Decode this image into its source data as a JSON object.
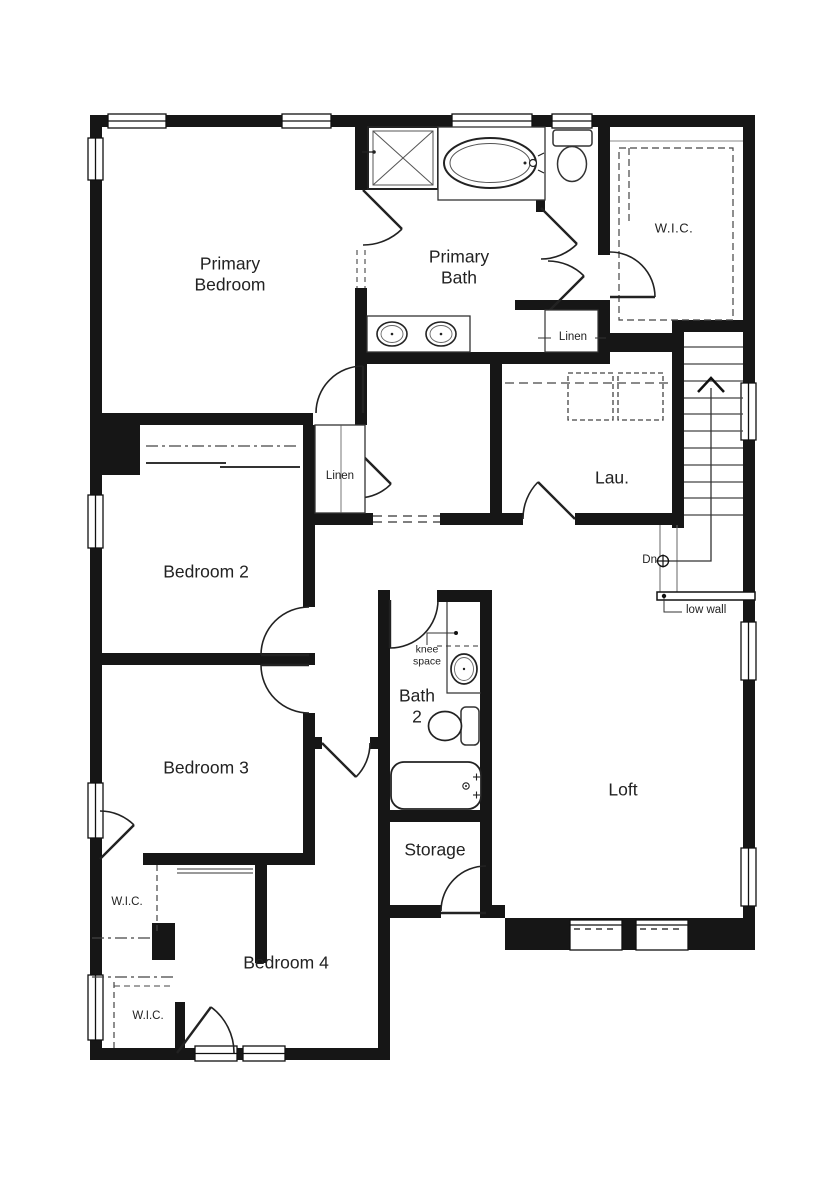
{
  "plan": {
    "rooms": {
      "primary_bedroom": {
        "line1": "Primary",
        "line2": "Bedroom"
      },
      "primary_bath": {
        "line1": "Primary",
        "line2": "Bath"
      },
      "wic_primary": {
        "label": "W.I.C."
      },
      "linen_bath": {
        "label": "Linen"
      },
      "linen_hall": {
        "label": "Linen"
      },
      "laundry": {
        "label": "Lau."
      },
      "bedroom_2": {
        "label": "Bedroom 2"
      },
      "bedroom_3": {
        "label": "Bedroom 3"
      },
      "bath_2": {
        "line1": "Bath",
        "line2": "2"
      },
      "storage": {
        "label": "Storage"
      },
      "loft": {
        "label": "Loft"
      },
      "wic_bedroom_3": {
        "label": "W.I.C."
      },
      "wic_bedroom_4": {
        "label": "W.I.C."
      },
      "bedroom_4": {
        "label": "Bedroom 4"
      }
    },
    "annotations": {
      "knee_space": {
        "line1": "knee",
        "line2": "space"
      },
      "down": {
        "label": "Dn"
      },
      "low_wall": {
        "label": "low wall"
      }
    },
    "colors": {
      "wall": "#161616",
      "line": "#333333",
      "background": "#ffffff",
      "text": "#222222"
    }
  }
}
